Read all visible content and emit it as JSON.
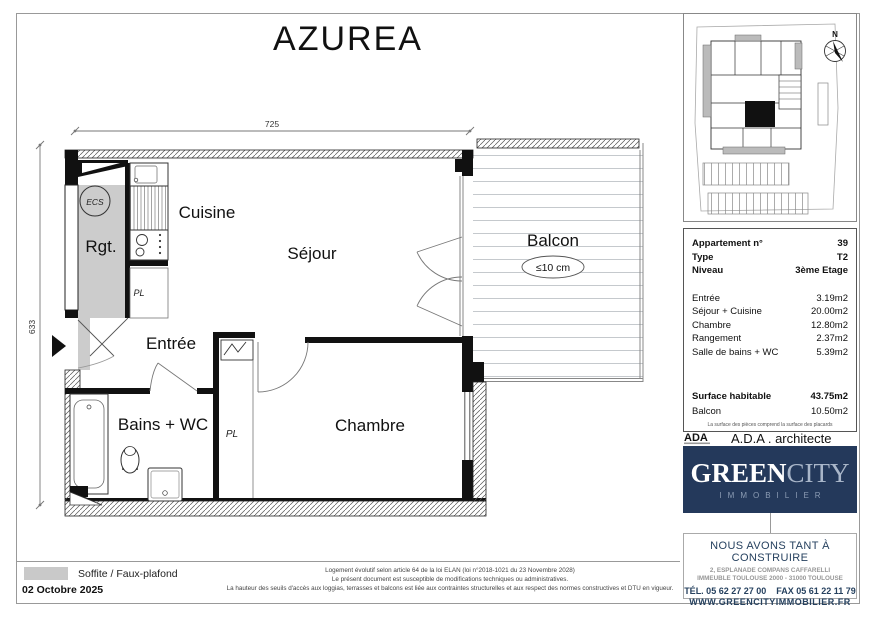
{
  "title": "AZUREA",
  "plan": {
    "dim_top": "725",
    "dim_left": "633",
    "labels": {
      "cuisine": "Cuisine",
      "sejour": "Séjour",
      "rgt": "Rgt.",
      "pl_kitchen": "PL",
      "entree": "Entrée",
      "bains": "Bains + WC",
      "pl_chambre": "PL",
      "chambre": "Chambre",
      "balcon": "Balcon",
      "balcon_note": "≤10 cm",
      "ecs": "ECS"
    }
  },
  "site_plan": {
    "north_label": "N"
  },
  "info_panel": {
    "head": [
      {
        "label": "Appartement n°",
        "value": "39"
      },
      {
        "label": "Type",
        "value": "T2"
      },
      {
        "label": "Niveau",
        "value": "3ème Etage"
      }
    ],
    "areas": [
      {
        "label": "Entrée",
        "value": "3.19m2"
      },
      {
        "label": "Séjour + Cuisine",
        "value": "20.00m2"
      },
      {
        "label": "Chambre",
        "value": "12.80m2"
      },
      {
        "label": "Rangement",
        "value": "2.37m2"
      },
      {
        "label": "Salle de bains + WC",
        "value": "5.39m2"
      }
    ],
    "totals": [
      {
        "label": "Surface habitable",
        "value": "43.75m2"
      },
      {
        "label": "Balcon",
        "value": "10.50m2"
      }
    ],
    "footnote": "La surface des pièces comprend la surface des placards"
  },
  "architect": {
    "logo_text": "ADA",
    "label": "A.D.A . architecte"
  },
  "brand": {
    "name_green": "GREEN",
    "name_city": "CITY",
    "subtitle": "IMMOBILIER",
    "tagline": "NOUS AVONS TANT À CONSTRUIRE",
    "address_line1": "2, ESPLANADE COMPANS CAFFARELLI",
    "address_line2": "IMMEUBLE TOULOUSE 2000 - 31000 TOULOUSE",
    "phone_fax": "TÉL. 05 62 27 27 00    FAX 05 61 22 11 79",
    "website": "WWW.GREENCITYIMMOBILIER.FR",
    "navy": "#24395b"
  },
  "footer": {
    "legend_label": "Soffite / Faux-plafond",
    "date": "02 Octobre 2025",
    "legal_line1": "Logement évolutif selon article 64 de la loi ELAN (loi n°2018-1021 du 23 Novembre 2028)",
    "legal_line2": "Le présent document est susceptible de modifications techniques ou administratives.",
    "legal_line3": "La hauteur des seuils d'accès aux loggias, terrasses et balcons est liée aux contraintes structurelles et aux respect des normes constructives et DTU en vigueur."
  }
}
